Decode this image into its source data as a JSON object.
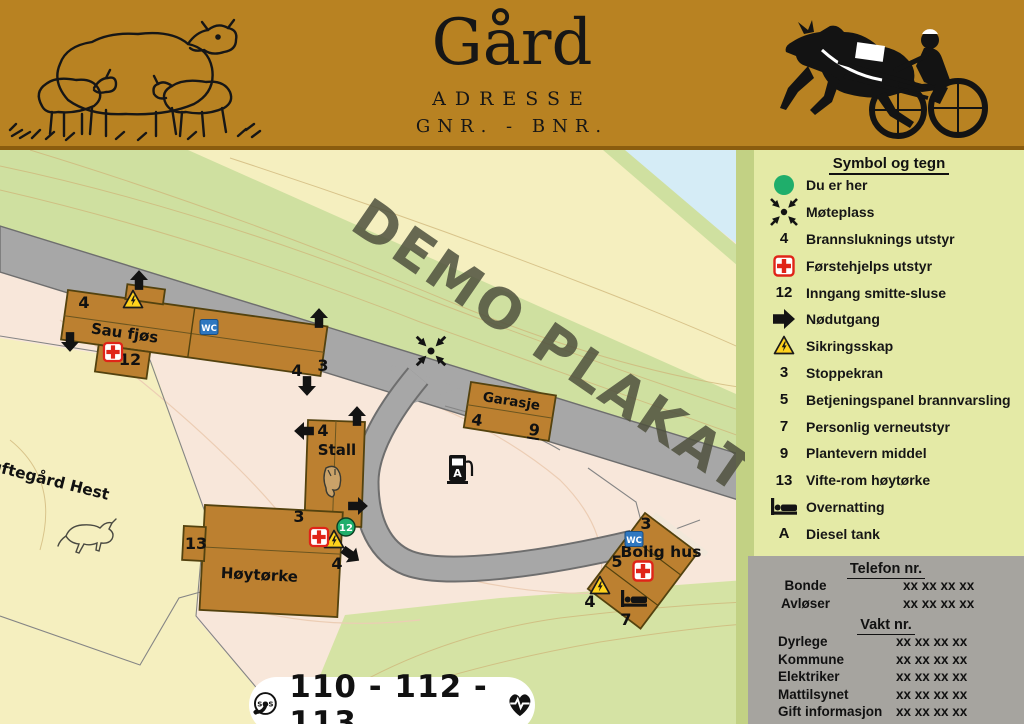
{
  "header": {
    "farm_title": "Gård",
    "address": "ADRESSE",
    "gnr_bnr": "GNR.  -  BNR."
  },
  "watermark": "DEMO PLAKAT",
  "map": {
    "building_labels": {
      "sau_fjos": "Sau fjøs",
      "stall": "Stall",
      "garasje": "Garasje",
      "hoytorke": "Høytørke",
      "bolig_hus": "Bolig hus"
    },
    "area_labels": {
      "paddock": "Luftegård Hest"
    },
    "tags": {
      "wc": "WC",
      "diesel": "A"
    },
    "numbers": {
      "n3": "3",
      "n4": "4",
      "n5": "5",
      "n7": "7",
      "n9": "9",
      "n12": "12",
      "n13": "13"
    }
  },
  "legend": {
    "title": "Symbol og tegn",
    "items": [
      {
        "icon": "location-dot",
        "label": "Du er her"
      },
      {
        "icon": "meeting-point",
        "label": "Møteplass"
      },
      {
        "icon": "number",
        "value": "4",
        "label": "Brannsluknings utstyr"
      },
      {
        "icon": "first-aid",
        "label": "Førstehjelps utstyr"
      },
      {
        "icon": "number",
        "value": "12",
        "label": "Inngang smitte-sluse"
      },
      {
        "icon": "exit-arrow",
        "label": "Nødutgang"
      },
      {
        "icon": "warning-triangle",
        "label": "Sikringsskap"
      },
      {
        "icon": "number",
        "value": "3",
        "label": "Stoppekran"
      },
      {
        "icon": "number",
        "value": "5",
        "label": "Betjeningspanel brannvarsling"
      },
      {
        "icon": "number",
        "value": "7",
        "label": "Personlig verneutstyr"
      },
      {
        "icon": "number",
        "value": "9",
        "label": "Plantevern middel"
      },
      {
        "icon": "number",
        "value": "13",
        "label": "Vifte-rom høytørke"
      },
      {
        "icon": "bed",
        "label": "Overnatting"
      },
      {
        "icon": "number",
        "value": "A",
        "label": "Diesel tank"
      }
    ]
  },
  "contacts": {
    "phone_title": "Telefon nr.",
    "phone_rows": [
      {
        "label": "Bonde",
        "number": "xx xx xx xx"
      },
      {
        "label": "Avløser",
        "number": "xx xx xx xx"
      }
    ],
    "guard_title": "Vakt nr.",
    "guard_rows": [
      {
        "label": "Dyrlege",
        "number": "xx xx xx xx"
      },
      {
        "label": "Kommune",
        "number": "xx xx xx xx"
      },
      {
        "label": "Elektriker",
        "number": "xx xx xx xx"
      },
      {
        "label": "Mattilsynet",
        "number": "xx xx xx xx"
      },
      {
        "label": "Gift informasjon",
        "number": "xx xx xx xx"
      }
    ]
  },
  "emergency": {
    "sos": "SOS",
    "numbers": "110 - 112 - 113"
  },
  "colors": {
    "header_brown": "#b88222",
    "legend_bg": "#e4eaa6",
    "phone_bg": "#a6a49f",
    "building": "#bc8030",
    "road": "#a7a7a7",
    "field_green": "#cfe0a0",
    "field_yellow": "#f5efbf",
    "farmyard_pink": "#f8e7da",
    "water_blue": "#d5ecf6",
    "marker_green": "#1fae6b",
    "wc_blue": "#2e77c0",
    "warning_yellow": "#ffd21c",
    "cross_red": "#e02418"
  }
}
